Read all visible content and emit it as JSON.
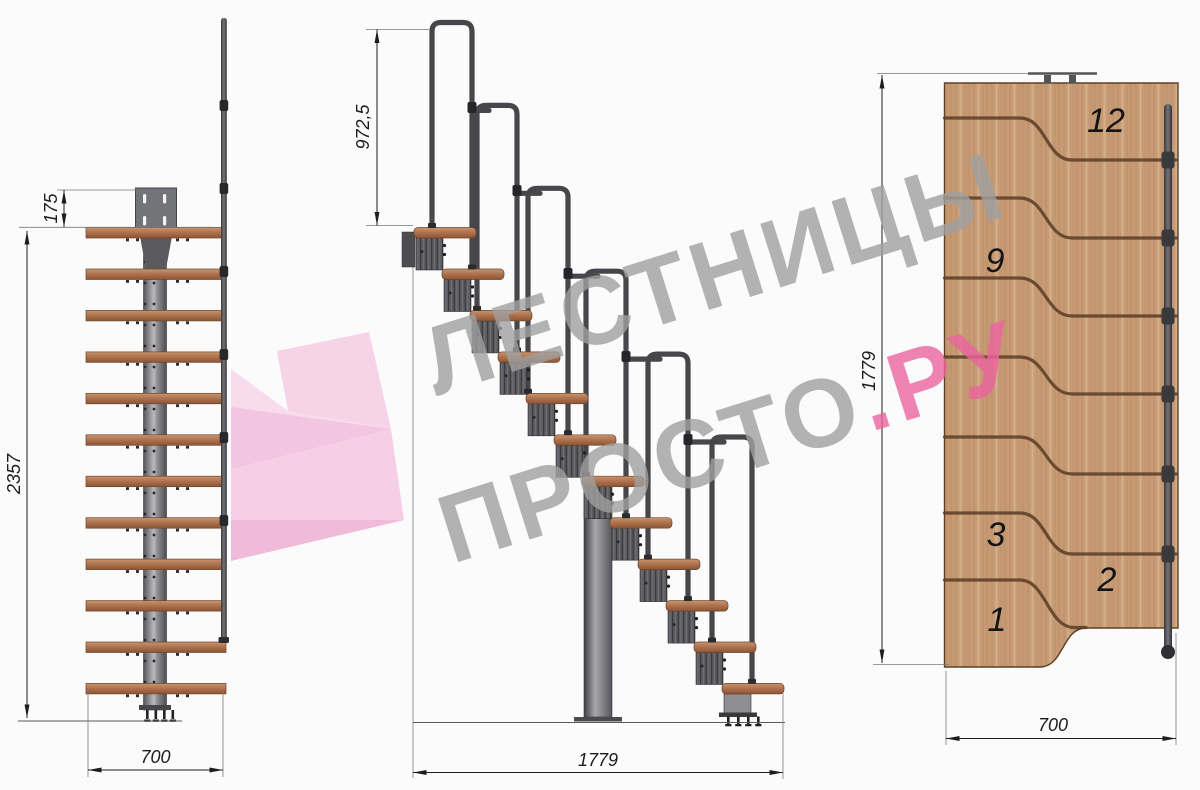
{
  "watermark": {
    "line1": "ЛЕСТНИЦЫ",
    "line2_gray": "ПРОСТО",
    "line2_dot": ".",
    "line2_pink": "РУ"
  },
  "front_view": {
    "dims": {
      "plate_offset": "175",
      "total_height": "2357",
      "width": "700"
    }
  },
  "side_view": {
    "dims": {
      "handrail_height": "972,5",
      "total_run": "1779"
    }
  },
  "plan_view": {
    "dims": {
      "total_run": "1779",
      "width": "700"
    },
    "step_labels": [
      "12",
      "9",
      "3",
      "2",
      "1"
    ]
  },
  "colors": {
    "pink_accent": "#ec649f",
    "watermark_gray": "#a0a0a0",
    "wood_step": "#a96e4b",
    "wood_panel": "#c79b74",
    "metal": "#5c5c61",
    "dimension_ink": "#1c1c1c"
  }
}
